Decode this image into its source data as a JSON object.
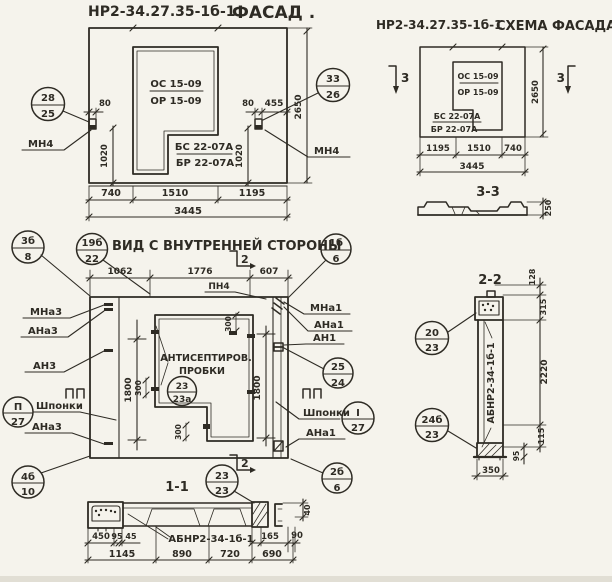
{
  "colors": {
    "paper": "#f5f3ec",
    "ink": "#2e2b24"
  },
  "facade": {
    "title_code": "НР2-34.27.35-1б-1",
    "title_name": "ФАСАД .",
    "mark_os": "ОС 15-09",
    "mark_or": "ОР 15-09",
    "mark_bs": "БС 22-07А",
    "mark_br": "БР 22-07А",
    "anchor_left": "МН4",
    "anchor_right": "МН4",
    "callout_left": {
      "num": "28",
      "den": "25"
    },
    "callout_right": {
      "num": "33",
      "den": "26"
    },
    "dims": {
      "off_left": "80",
      "h_left": "1020",
      "off_right": "80",
      "w_right": "455",
      "h_right": "1020",
      "height": "2650",
      "w1": "740",
      "w2": "1510",
      "w3": "1195",
      "total": "3445"
    }
  },
  "scheme": {
    "title_code": "НР2-34.27.35-1б-1",
    "title_name": "СХЕМА ФАСАДА",
    "mark_os": "ОС 15-09",
    "mark_or": "ОР 15-09",
    "mark_bs": "БС 22-07А",
    "mark_br": "БР 22-07А",
    "marker_left": "3",
    "marker_right": "3",
    "dims": {
      "w1": "1195",
      "w2": "1510",
      "w3": "740",
      "total": "3445",
      "height": "2650"
    }
  },
  "section33": {
    "title": "3-3",
    "thickness": "250"
  },
  "inner": {
    "title": "ВИД С ВНУТРЕННЕЙ СТОРОНЫ",
    "marker_top": "2",
    "marker_bottom": "2",
    "pn4": "ПН4",
    "plugs_line1": "АНТИСЕПТИРОВ.",
    "plugs_line2": "ПРОБКИ",
    "left": {
      "mna3": "МНа3",
      "ana3_top": "АНа3",
      "an3": "АН3",
      "shponki": "Шпонки",
      "ana3_bottom": "АНа3"
    },
    "right": {
      "mna1": "МНа1",
      "ana1_top": "АНа1",
      "an1": "АН1",
      "shponki": "Шпонки",
      "ana1_bottom": "АНа1"
    },
    "callouts": {
      "c3b8": {
        "num": "3б",
        "den": "8"
      },
      "c19b22": {
        "num": "19б",
        "den": "22"
      },
      "c1b6": {
        "num": "1б",
        "den": "6"
      },
      "c2524": {
        "num": "25",
        "den": "24"
      },
      "ci27": {
        "num": "I",
        "den": "27"
      },
      "cp27": {
        "num": "П",
        "den": "27"
      },
      "c4b10": {
        "num": "4б",
        "den": "10"
      },
      "c23a": {
        "num": "23",
        "den": "23а"
      },
      "c2323": {
        "num": "23",
        "den": "23"
      },
      "c2b6": {
        "num": "2б",
        "den": "6"
      }
    },
    "dims": {
      "w1": "1062",
      "w2": "1776",
      "w3": "607",
      "h_left": "1800",
      "h_right": "1800",
      "p1": "300",
      "p2": "300",
      "p3": "300"
    }
  },
  "section11": {
    "title": "1-1",
    "mark": "АБНР2-34-1б-1",
    "dims": {
      "d450": "450",
      "d95": "95",
      "d45": "45",
      "d165": "165",
      "d90": "90",
      "d1145": "1145",
      "d890": "890",
      "d720": "720",
      "d690": "690",
      "d40": "40"
    }
  },
  "section22": {
    "title": "2-2",
    "mark": "АБНР2-34-1б-1",
    "dims": {
      "d128": "128",
      "d315": "315",
      "d2220": "2220",
      "d115": "115",
      "d95": "95",
      "d350": "350"
    },
    "callouts": {
      "c2023": {
        "num": "20",
        "den": "23"
      },
      "c24b23": {
        "num": "24б",
        "den": "23"
      }
    }
  }
}
